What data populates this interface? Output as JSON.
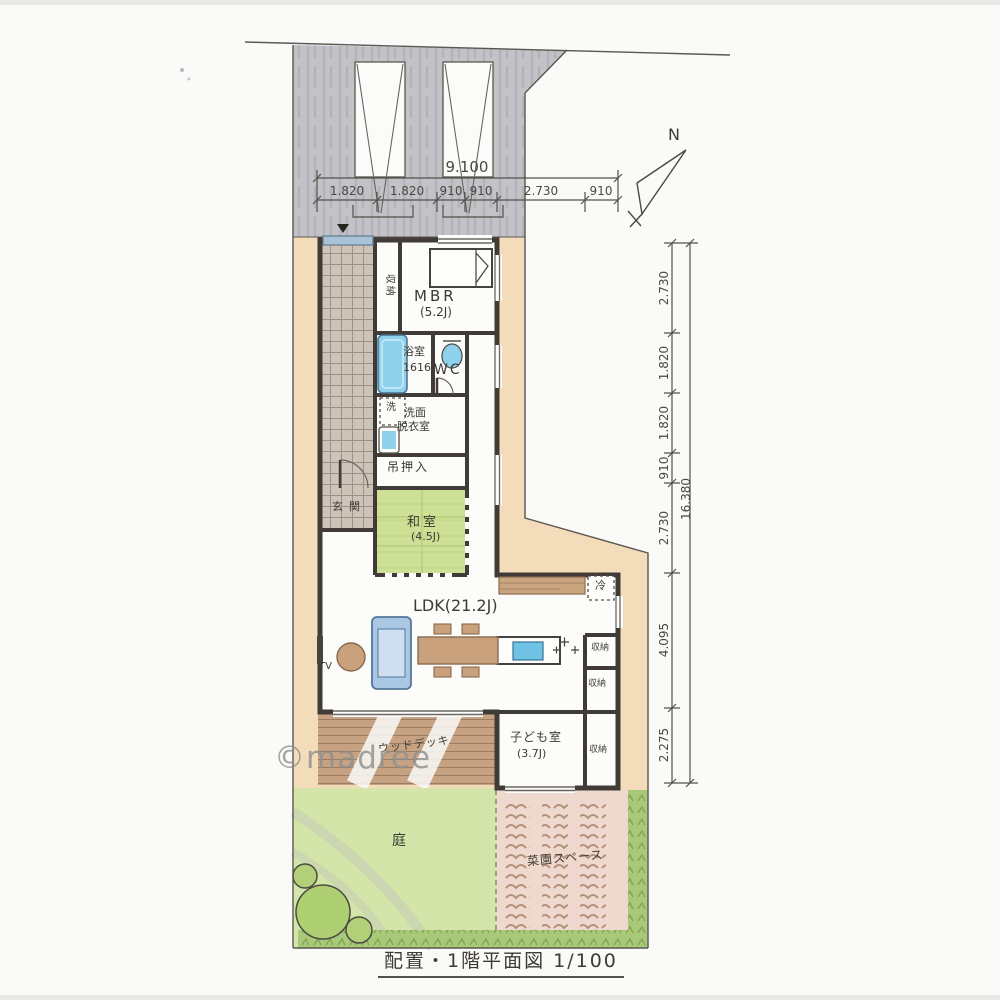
{
  "drawing_title": "配置・1階平面図 1/100",
  "watermark": "©madree",
  "compass": {
    "north_label": "N"
  },
  "dimensions": {
    "top": {
      "total": "9.100",
      "segments": [
        "1.820",
        "1.820",
        "910",
        "910",
        "2.730",
        "910"
      ]
    },
    "right": {
      "total": "16.380",
      "segments": [
        "2.730",
        "1.820",
        "1.820",
        "910",
        "2.730",
        "4.095",
        "2.275"
      ]
    }
  },
  "rooms": {
    "mbr": {
      "label": "MBR",
      "area": "(5.2J)"
    },
    "mbr_closet": {
      "label": "収納"
    },
    "bathroom": {
      "label": "浴室",
      "size": "1616"
    },
    "toilet": {
      "label": "WC"
    },
    "laundry_box": {
      "label": "洗"
    },
    "washroom": {
      "line1": "洗面",
      "line2": "脱衣室"
    },
    "hanging_closet": {
      "label": "吊押入"
    },
    "entrance": {
      "label": "玄関"
    },
    "washitsu": {
      "label": "和室",
      "area": "(4.5J)"
    },
    "ldk": {
      "label": "LDK(21.2J)"
    },
    "tv": {
      "label": "TV"
    },
    "refrigerator": {
      "label": "冷"
    },
    "storage_1": {
      "label": "収納"
    },
    "storage_2": {
      "label": "収納"
    },
    "kids_room": {
      "label": "子ども室",
      "area": "(3.7J)"
    },
    "kids_closet": {
      "label": "収納"
    },
    "wood_deck": {
      "label": "ウッドデッキ"
    },
    "garden": {
      "label": "庭"
    },
    "vegetable_garden": {
      "label": "菜園スペース"
    }
  },
  "colors": {
    "wall": "#403b36",
    "water_blue": "#8ed1ea",
    "tatami_green": "#cde096",
    "wood_brown": "#c9a17c",
    "deck_brown": "#c6a283",
    "ground_tan": "#f3dcba",
    "parking_gray": "#c2c2c7",
    "garden_green": "#d3e5a8",
    "hedge_green": "#a8c977",
    "soil_pink": "#efd9ce",
    "sofa_blue": "#aac7e4"
  }
}
